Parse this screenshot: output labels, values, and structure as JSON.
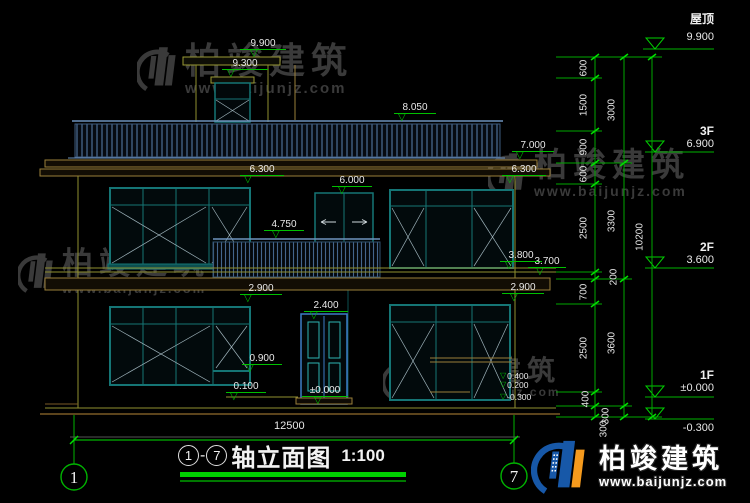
{
  "watermark": {
    "brand": "柏竣建筑",
    "url": "www.baijunjz.com"
  },
  "title_block": {
    "axis_from": "1",
    "dash": "-",
    "axis_to": "7",
    "name": "轴立面图",
    "scale": "1:100"
  },
  "axis_bubbles": {
    "left": "1",
    "right": "7"
  },
  "overall_dim": "12500",
  "floor_levels": [
    {
      "name": "屋顶",
      "value": "9.900"
    },
    {
      "name": "3F",
      "value": "6.900"
    },
    {
      "name": "2F",
      "value": "3.600"
    },
    {
      "name": "1F",
      "value": "±0.000"
    },
    {
      "name": "",
      "value": "-0.300"
    }
  ],
  "dim_chains": {
    "inner": [
      "600",
      "1500",
      "900",
      "600",
      "2500",
      "200",
      "700",
      "2500",
      "400",
      "300"
    ],
    "mid": [
      "3000",
      "3300",
      "3600",
      "300"
    ],
    "total": "10200"
  },
  "spot_elevations": [
    "9.900",
    "9.300",
    "8.050",
    "7.000",
    "6.300",
    "6.300",
    "6.000",
    "4.750",
    "3.800",
    "3.700",
    "2.900",
    "2.900",
    "2.400",
    "0.900",
    "0.100",
    "±0.000",
    "0.400",
    "0.200",
    "-0.300"
  ],
  "colors": {
    "dim_green": "#00c000",
    "cad_teal": "#157575",
    "cad_steel_blue": "#4c6e96",
    "cad_olive": "#8f8f2f",
    "watermark_gray": "#3a3a3a",
    "logo_blue": "#1758a8",
    "logo_orange": "#f59a1d"
  }
}
